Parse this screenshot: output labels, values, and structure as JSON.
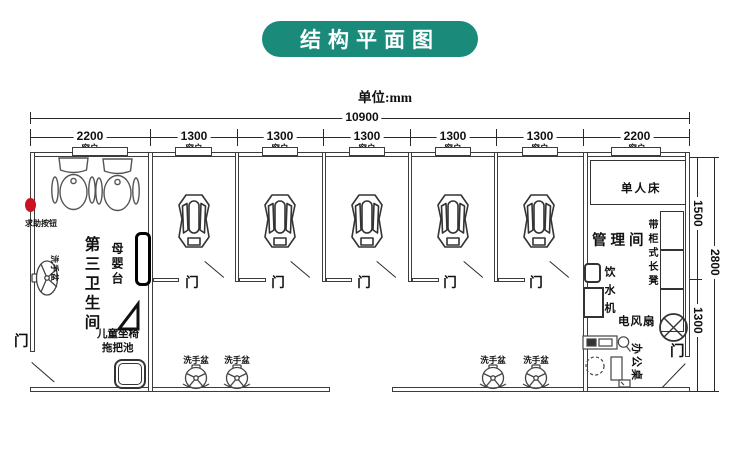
{
  "title": "结构平面图",
  "unit_label": "单位:mm",
  "colors": {
    "accent": "#1a8a7b",
    "help_button": "#cc1122",
    "line": "#3c3c3c"
  },
  "dimensions": {
    "total_width": "10900",
    "top_segments": [
      {
        "value": "2200",
        "window": "窗户"
      },
      {
        "value": "1300",
        "window": "窗户"
      },
      {
        "value": "1300",
        "window": "窗户"
      },
      {
        "value": "1300",
        "window": "窗户"
      },
      {
        "value": "1300",
        "window": "窗户"
      },
      {
        "value": "1300",
        "window": "窗户"
      },
      {
        "value": "2200",
        "window": "窗户"
      }
    ],
    "right_top": "1500",
    "right_total": "2800",
    "right_bottom": "1300"
  },
  "left_room": {
    "name": "第三卫生间",
    "help_button_label": "求助按钮",
    "baby_care_table": "母婴台",
    "child_seat": "儿童坐椅",
    "mop_pool": "拖把池",
    "wash_basin": "洗手盆",
    "door_label": "门"
  },
  "stalls": {
    "door_label": "门"
  },
  "washroom": {
    "basin_label": "洗手盆"
  },
  "management_room": {
    "name": "管理间",
    "single_bed": "单人床",
    "cabinet_bench": "带柜式长凳",
    "water_dispenser": "饮水机",
    "electric_fan": "电风扇",
    "office_desk": "办公桌",
    "door_label": "门"
  }
}
